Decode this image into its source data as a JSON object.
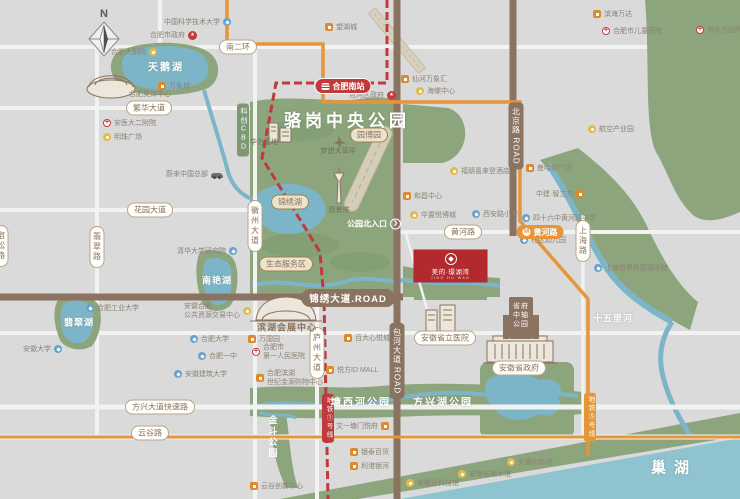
{
  "meta": {
    "width": 740,
    "height": 499
  },
  "compass": {
    "label": "N"
  },
  "project": {
    "name": "美的·璟湖湾",
    "subtitle": "JING HU WAN"
  },
  "colors": {
    "park": "#8ca57d",
    "water": "#7db5c8",
    "chaohu": "#8ec3cf",
    "road_brown": "#8b7361",
    "metro_red": "#c0393b",
    "metro_orange": "#e5953a",
    "project_red": "#b2292e",
    "badge_text": "#8a7158",
    "poi_text": "#8b8273"
  },
  "items": [
    {
      "n": "badge-nanerhuan",
      "t": "bw",
      "s": "南二环",
      "x": 238,
      "y": 47
    },
    {
      "n": "badge-fanhua-avenue",
      "t": "bw",
      "s": "繁华大道",
      "x": 149,
      "y": 108
    },
    {
      "n": "badge-huayuan-avenue",
      "t": "bw",
      "s": "花园大道",
      "x": 150,
      "y": 210
    },
    {
      "n": "badge-huanghe-road",
      "t": "bw",
      "s": "黄河路",
      "x": 463,
      "y": 232
    },
    {
      "n": "badge-fangxing-expressway",
      "t": "bw",
      "s": "方兴大道快速路",
      "x": 160,
      "y": 407
    },
    {
      "n": "badge-yungu-road",
      "t": "bw",
      "s": "云谷路",
      "x": 150,
      "y": 433
    },
    {
      "n": "badge-provincial-government",
      "t": "bw",
      "s": "安徽省政府",
      "x": 519,
      "y": 368
    },
    {
      "n": "badge-provincial-hospital",
      "t": "bw",
      "s": "安徽省立医院",
      "x": 445,
      "y": 338
    },
    {
      "n": "badge-feicui-road",
      "t": "bwv",
      "s": "翡翠路",
      "x": 97,
      "y": 247
    },
    {
      "n": "badge-susong-road",
      "t": "bwv",
      "s": "宿松路",
      "x": 1,
      "y": 246
    },
    {
      "n": "badge-huizhou-avenue",
      "t": "bwv",
      "s": "徽州大道",
      "x": 255,
      "y": 226
    },
    {
      "n": "badge-luzhou-avenue",
      "t": "bwv",
      "s": "庐州大道",
      "x": 317,
      "y": 353
    },
    {
      "n": "badge-shanghai-road",
      "t": "bwv",
      "s": "上海路",
      "x": 583,
      "y": 241
    },
    {
      "n": "badge-beijing-road",
      "t": "bbv",
      "s": "北京路 ROAD",
      "x": 516,
      "y": 136
    },
    {
      "n": "badge-baohe-avenue",
      "t": "bbv",
      "s": "包河大道 ROAD",
      "x": 397,
      "y": 361
    },
    {
      "n": "badge-kechuang-cbd",
      "t": "bgv",
      "s": "科创CBD",
      "x": 243,
      "y": 130
    },
    {
      "n": "badge-jinxiu-avenue",
      "t": "bb",
      "s": "锦绣大道.ROAD",
      "x": 348,
      "y": 298
    },
    {
      "n": "badge-yuanboyuan",
      "t": "bt",
      "s": "园博园",
      "x": 369,
      "y": 135
    },
    {
      "n": "badge-eco-service-area",
      "t": "bt",
      "s": "生态服务区",
      "x": 286,
      "y": 264
    },
    {
      "n": "badge-jinxiu-lake",
      "t": "bt",
      "s": "锦绣湖",
      "x": 290,
      "y": 202
    },
    {
      "n": "badge-metro-line1",
      "t": "bmr",
      "s": "地铁①号线",
      "x": 328,
      "y": 418
    },
    {
      "n": "badge-metro-line5",
      "t": "bmo",
      "s": "地铁⑤号线",
      "x": 590,
      "y": 417
    },
    {
      "n": "badge-hefei-south-station",
      "t": "st",
      "s": "合肥南站",
      "x": 343,
      "y": 86
    },
    {
      "n": "badge-metro-huanghe-station",
      "t": "mo",
      "s": "黄河路",
      "x": 540,
      "y": 232
    },
    {
      "n": "label-tianehu-lake",
      "t": "lw",
      "s": "天鹅湖",
      "x": 166,
      "y": 66,
      "fs": 10,
      "ls": 2
    },
    {
      "n": "label-feicuihu-lake",
      "t": "lw",
      "s": "翡翠湖",
      "x": 79,
      "y": 322,
      "fs": 9,
      "ls": 1
    },
    {
      "n": "label-nanyanhu-lake",
      "t": "lw",
      "s": "南艳湖",
      "x": 217,
      "y": 280,
      "fs": 9,
      "ls": 1
    },
    {
      "n": "label-luogang-park-title",
      "t": "lw",
      "s": "骆岗中央公园",
      "x": 347,
      "y": 119,
      "fs": 17,
      "ls": 4,
      "b": 1
    },
    {
      "n": "label-tangxihe-park",
      "t": "lw",
      "s": "塘西河公园",
      "x": 361,
      "y": 401,
      "fs": 10,
      "ls": 2
    },
    {
      "n": "label-fangxinghu-park",
      "t": "lw",
      "s": "方兴湖公园",
      "x": 443,
      "y": 401,
      "fs": 10,
      "ls": 2
    },
    {
      "n": "label-jindou-park",
      "t": "lwv",
      "s": "金斗公园",
      "x": 273,
      "y": 437,
      "fs": 9,
      "ls": 2
    },
    {
      "n": "label-shiwulihe-river",
      "t": "lw",
      "s": "十五里河",
      "x": 613,
      "y": 318,
      "fs": 9,
      "ls": 1
    },
    {
      "n": "label-chaohu-lake",
      "t": "lw",
      "s": "巢湖",
      "x": 674,
      "y": 467,
      "fs": 15,
      "ls": 8,
      "b": 1
    },
    {
      "n": "label-expo-center",
      "t": "lb",
      "s": "滨湖会展中心",
      "x": 287,
      "y": 327,
      "fs": 9
    },
    {
      "n": "label-dream-lawn",
      "t": "lt",
      "s": "梦想大草坪",
      "x": 338,
      "y": 151
    },
    {
      "n": "label-viewing-tower",
      "t": "lt",
      "s": "观景塔",
      "x": 339,
      "y": 210
    },
    {
      "n": "label-huawei-base",
      "t": "lt",
      "s": "华为基地",
      "x": 264,
      "y": 142
    },
    {
      "n": "label-sports-center",
      "t": "pt",
      "s": "合肥奥体中心",
      "x": 150,
      "y": 94
    },
    {
      "n": "label-government-axis-park",
      "t": "gt",
      "l": [
        "省府",
        "中轴",
        "公园"
      ],
      "x": 521,
      "y": 316
    },
    {
      "n": "label-north-entrance",
      "t": "ent",
      "s": "公园北入口",
      "x": 374,
      "y": 224
    },
    {
      "n": "poi-ustc",
      "t": "poi",
      "s": "中国科学技术大学",
      "i": "blue",
      "d": "r",
      "x": 164,
      "y": 22
    },
    {
      "n": "poi-hefei-government",
      "t": "poi",
      "s": "合肥市政府",
      "i": "gov",
      "d": "r",
      "x": 150,
      "y": 35
    },
    {
      "n": "poi-grand-theater",
      "t": "poi",
      "s": "合肥大剧院",
      "i": "yellow",
      "d": "r",
      "x": 111,
      "y": 52
    },
    {
      "n": "poi-mixc-mall",
      "t": "poi",
      "s": "万象城",
      "i": "orange",
      "d": "l",
      "x": 158,
      "y": 86
    },
    {
      "n": "poi-anyi-2nd-hospital",
      "t": "poi",
      "s": "安医大二附院",
      "i": "hosp",
      "d": "l",
      "x": 103,
      "y": 123
    },
    {
      "n": "poi-mingzhu-square",
      "t": "poi",
      "s": "明珠广场",
      "i": "yellow",
      "d": "l",
      "x": 103,
      "y": 137
    },
    {
      "n": "poi-nio-china-hq",
      "t": "poi",
      "s": "蔚来中国总部",
      "i": "car",
      "d": "r",
      "x": 166,
      "y": 174
    },
    {
      "n": "poi-tsinghua-institute",
      "t": "poi",
      "s": "清华大学研究院",
      "i": "blue",
      "d": "r",
      "x": 177,
      "y": 251
    },
    {
      "n": "poi-hefei-univ-of-tech",
      "t": "poi",
      "s": "合肥工业大学",
      "i": "blue",
      "d": "l",
      "x": 86,
      "y": 308
    },
    {
      "n": "poi-public-resource-center",
      "t": "poi",
      "l": [
        "安徽合肥",
        "公共资源交易中心"
      ],
      "i": "yellow",
      "d": "r",
      "x": 184,
      "y": 311
    },
    {
      "n": "poi-anhui-university",
      "t": "poi",
      "s": "安徽大学",
      "i": "blue",
      "d": "r",
      "x": 23,
      "y": 349
    },
    {
      "n": "poi-hefei-university",
      "t": "poi",
      "s": "合肥大学",
      "i": "blue",
      "d": "l",
      "x": 190,
      "y": 339
    },
    {
      "n": "poi-hefei-no1-school",
      "t": "poi",
      "s": "合肥一中",
      "i": "blue",
      "d": "l",
      "x": 198,
      "y": 356
    },
    {
      "n": "poi-anhui-jianzhu-university",
      "t": "poi",
      "s": "安徽建筑大学",
      "i": "blue",
      "d": "l",
      "x": 174,
      "y": 374
    },
    {
      "n": "poi-wanghucheng",
      "t": "poi",
      "s": "望湖城",
      "i": "orange",
      "d": "l",
      "x": 325,
      "y": 27
    },
    {
      "n": "poi-baohe-district-government",
      "t": "poi",
      "s": "包河区政府",
      "i": "gov",
      "d": "r",
      "x": 349,
      "y": 95
    },
    {
      "n": "poi-xianhe-mixc",
      "t": "poi",
      "s": "仙河万象汇",
      "i": "orange",
      "d": "l",
      "x": 401,
      "y": 79
    },
    {
      "n": "poi-hailuo-center",
      "t": "poi",
      "s": "海螺中心",
      "i": "yellow",
      "d": "l",
      "x": 416,
      "y": 91
    },
    {
      "n": "poi-binhai-wanda",
      "t": "poi",
      "s": "滨海万达",
      "i": "orange",
      "d": "l",
      "x": 593,
      "y": 14
    },
    {
      "n": "poi-children-hospital",
      "t": "poi",
      "s": "合肥市儿童医院",
      "i": "hosp",
      "d": "l",
      "x": 602,
      "y": 31
    },
    {
      "n": "poi-aviation-industry-park",
      "t": "poi",
      "s": "航空产业园",
      "i": "yellow",
      "d": "l",
      "x": 588,
      "y": 129
    },
    {
      "n": "poi-boe-hospital",
      "t": "poi",
      "s": "京东方医院",
      "i": "hosp",
      "d": "l",
      "x": 696,
      "y": 30
    },
    {
      "n": "poi-sheraton-hotel",
      "t": "poi",
      "s": "福朋喜来登酒店",
      "i": "yellow",
      "d": "l",
      "x": 450,
      "y": 171
    },
    {
      "n": "poi-manhattan-plaza",
      "t": "poi",
      "s": "曼哈顿广场",
      "i": "orange",
      "d": "l",
      "x": 526,
      "y": 168
    },
    {
      "n": "poi-zhongjian-cube",
      "t": "poi",
      "s": "中建·智立方",
      "i": "orange",
      "d": "r",
      "x": 536,
      "y": 194
    },
    {
      "n": "poi-hechang-center",
      "t": "poi",
      "s": "和昌中心",
      "i": "orange",
      "d": "l",
      "x": 403,
      "y": 196
    },
    {
      "n": "poi-huazhi-yuebocheng",
      "t": "poi",
      "s": "华置悦博城",
      "i": "yellow",
      "d": "l",
      "x": 410,
      "y": 215
    },
    {
      "n": "poi-xian-road-primary-school",
      "t": "poi",
      "s": "西安路小学",
      "i": "blue",
      "d": "l",
      "x": 472,
      "y": 214
    },
    {
      "n": "poi-no46-middle-school",
      "t": "poi",
      "s": "四十六中黄河路中学",
      "i": "blue",
      "d": "l",
      "x": 522,
      "y": 218
    },
    {
      "n": "poi-community-kindergarten",
      "t": "poi",
      "s": "社区幼儿园",
      "i": "blue",
      "d": "l",
      "x": 520,
      "y": 240
    },
    {
      "n": "poi-shanghai-foreign-language-school",
      "t": "poi",
      "s": "上海世界外国语学校",
      "i": "blue",
      "d": "l",
      "x": 594,
      "y": 268
    },
    {
      "n": "poi-wanguo-garden",
      "t": "poi",
      "s": "万国园",
      "i": "orange",
      "d": "l",
      "x": 248,
      "y": 339
    },
    {
      "n": "poi-first-peoples-hospital",
      "t": "poi",
      "l": [
        "合肥市",
        "第一人民医院"
      ],
      "i": "hosp",
      "d": "l",
      "x": 252,
      "y": 352
    },
    {
      "n": "poi-binhu-shopping-mall",
      "t": "poi",
      "l": [
        "合肥滨湖",
        "世纪金源购物中心"
      ],
      "i": "orange",
      "d": "l",
      "x": 256,
      "y": 378
    },
    {
      "n": "poi-baida-xinyuecheng",
      "t": "poi",
      "s": "百大心悦城",
      "i": "orange",
      "d": "l",
      "x": 344,
      "y": 338
    },
    {
      "n": "poi-yuefang-id-mall",
      "t": "poi",
      "s": "悦方ID MALL",
      "i": "orange",
      "d": "l",
      "x": 326,
      "y": 370
    },
    {
      "n": "poi-wenyi-tangmen-yuefu",
      "t": "poi",
      "s": "文一塘门悦府",
      "i": "orange",
      "d": "r",
      "x": 336,
      "y": 426
    },
    {
      "n": "poi-yintai-department-store",
      "t": "poi",
      "s": "银泰百货",
      "i": "orange",
      "d": "l",
      "x": 350,
      "y": 452
    },
    {
      "n": "poi-ligang-galaxy",
      "t": "poi",
      "s": "利港银河",
      "i": "orange",
      "d": "l",
      "x": 350,
      "y": 466
    },
    {
      "n": "poi-yungu-innovation-center",
      "t": "poi",
      "s": "云谷创新中心",
      "i": "orange",
      "d": "l",
      "x": 250,
      "y": 486
    },
    {
      "n": "poi-anhui-science-museum",
      "t": "poi",
      "s": "安徽省科技馆",
      "i": "yellow",
      "d": "l",
      "x": 406,
      "y": 483
    },
    {
      "n": "poi-anhui-art-museum",
      "t": "poi",
      "s": "安徽省美术馆",
      "i": "yellow",
      "d": "l",
      "x": 458,
      "y": 474
    },
    {
      "n": "poi-anhui-innovation-museum",
      "t": "poi",
      "s": "安徽创新馆",
      "i": "yellow",
      "d": "l",
      "x": 507,
      "y": 462
    }
  ]
}
